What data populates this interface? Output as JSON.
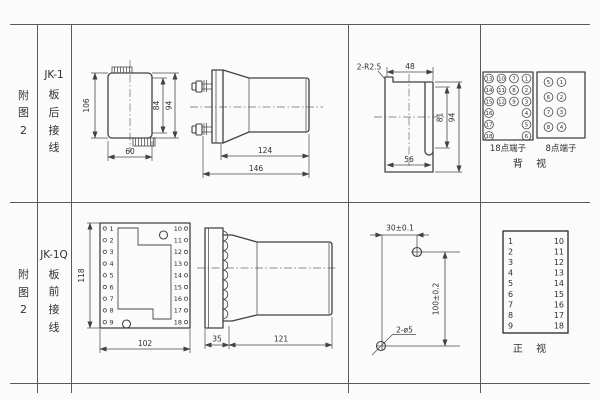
{
  "sheet": {
    "bg": "#fbfbfb",
    "ink": "#424242"
  },
  "row1": {
    "figure": "附图2",
    "model": "JK-1",
    "wiring": "板后接线",
    "rear": {
      "h_total": "106",
      "h_inner": "84",
      "h_outer": "94",
      "w_bottom": "60"
    },
    "side": {
      "body": "124",
      "total": "146"
    },
    "cutout": {
      "radius": "2-R2.5",
      "top": "48",
      "inner": "81",
      "outer": "94",
      "bottom": "56"
    },
    "t18": {
      "caption": "18点端子",
      "cells": [
        "13",
        "10",
        "7",
        "1",
        "14",
        "11",
        "8",
        "2",
        "15",
        "12",
        "9",
        "3",
        "16",
        "4",
        "17",
        "5",
        "18",
        "6"
      ]
    },
    "t8": {
      "caption": "8点端子",
      "left": [
        "5",
        "6",
        "7",
        "8"
      ],
      "right": [
        "1",
        "2",
        "3",
        "4"
      ]
    },
    "view": "背 视"
  },
  "row2": {
    "figure": "附图2",
    "model": "JK-1Q",
    "wiring": "板前接线",
    "front": {
      "height": "118",
      "width": "102",
      "left": [
        "1",
        "2",
        "3",
        "4",
        "5",
        "6",
        "7",
        "8",
        "9"
      ],
      "right": [
        "10",
        "11",
        "12",
        "13",
        "14",
        "15",
        "16",
        "17",
        "18"
      ]
    },
    "side": {
      "plate": "35",
      "body": "121"
    },
    "drill": {
      "h": "30±0.1",
      "v": "100±0.2",
      "holes": "2-ø5"
    },
    "table": {
      "left": [
        "1",
        "2",
        "3",
        "4",
        "5",
        "6",
        "7",
        "8",
        "9"
      ],
      "right": [
        "10",
        "11",
        "12",
        "13",
        "14",
        "15",
        "16",
        "17",
        "18"
      ],
      "caption": "正 视"
    }
  }
}
